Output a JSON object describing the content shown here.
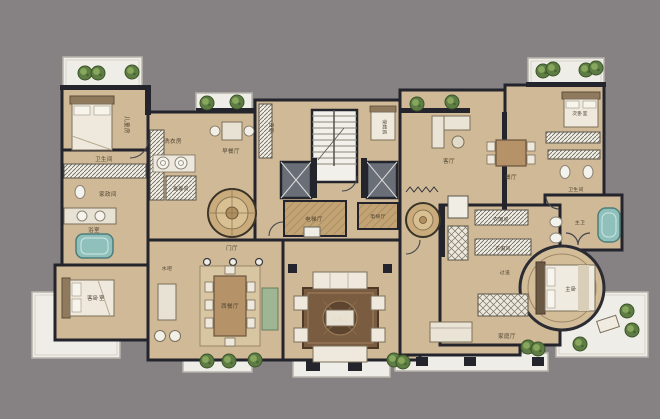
{
  "meta": {
    "type": "color-rendered residential floor plan",
    "units": "multi-room luxury apartment with central elevator core"
  },
  "palette": {
    "background": "#868283",
    "wall": "#23242c",
    "floor": "#cfb996",
    "floor_dark": "#c2a376",
    "terrace": "#efede7",
    "plant_green": "#5d7d44",
    "water_teal": "#8fc0bb",
    "rug_brown": "#7a5c41",
    "furniture_cream": "#efe9dd",
    "buffet_green": "#9eb694"
  },
  "labels": {
    "kids_room": "儿童房",
    "bath_left": "卫生间",
    "store_left": "家政间",
    "bath_spa": "浴室",
    "laundry": "洗衣房",
    "utility": "备餐间",
    "breakfast": "早餐厅",
    "west_kitchen": "西厨",
    "nanny": "保姆房",
    "lobby_left": "电梯厅",
    "lobby_right": "电梯厅",
    "foyer": "门厅",
    "guest_bed": "客卧室",
    "bar": "水吧",
    "dining_west": "西餐厅",
    "reception": "会客厅",
    "living_right": "客厅",
    "dining_right": "餐厅",
    "bed2": "次卧室",
    "bath_right": "卫生间",
    "master_bath": "主卫",
    "cloak1": "衣帽间",
    "cloak2": "衣帽间",
    "hallway": "过道",
    "family": "家庭厅",
    "master": "主卧"
  }
}
